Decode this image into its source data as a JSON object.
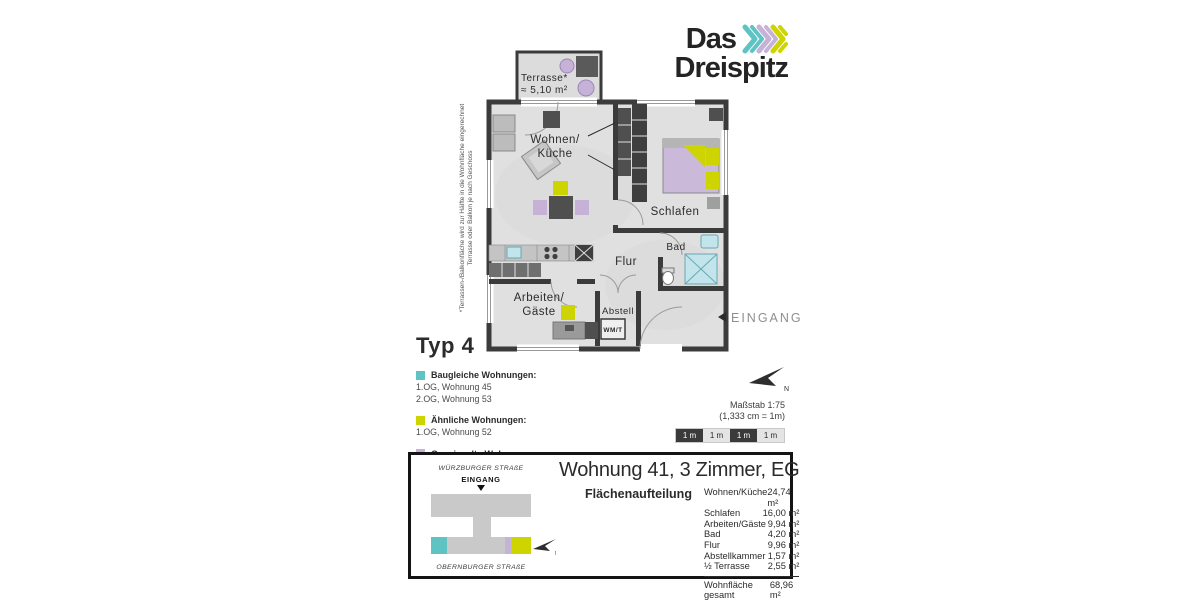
{
  "colors": {
    "teal": "#5fc3c3",
    "lavender": "#c5b2d6",
    "yellow_green": "#cdd400",
    "wall_dark": "#3b3b3b",
    "sanitary_blue": "#c2e5eb"
  },
  "logo": {
    "line1": "Das",
    "line2": "Dreispitz"
  },
  "floorplan": {
    "labels": {
      "terrasse_line1": "Terrasse*",
      "terrasse_line2": "≈ 5,10 m²",
      "wohnen_line1": "Wohnen/",
      "wohnen_line2": "Küche",
      "schlafen": "Schlafen",
      "bad": "Bad",
      "flur": "Flur",
      "arbeiten_line1": "Arbeiten/",
      "arbeiten_line2": "Gäste",
      "abstell": "Abstell",
      "wmt": "WM/T",
      "eingang": "EINGANG",
      "north": "N"
    },
    "footnote_line1": "*Terrassen-/Balkonfläche wird zur Hälfte in die Wohnfläche eingerechnet",
    "footnote_line2": "Terrasse oder Balkon je nach Geschoss"
  },
  "type_label": "Typ 4",
  "legend": [
    {
      "color": "#5fc3c3",
      "title": "Baugleiche Wohnungen:",
      "items": [
        "1.OG, Wohnung 45",
        "2.OG, Wohnung 53"
      ]
    },
    {
      "color": "#cdd400",
      "title": "Ähnliche Wohnungen:",
      "items": [
        "1.OG, Wohnung 52"
      ]
    },
    {
      "color": "#c5b2d6",
      "title": "Gespiegelte Wohnungen:",
      "items": [
        "2.OG, Wohnung 60"
      ]
    }
  ],
  "scale": {
    "line1": "Maßstab 1:75",
    "line2": "(1,333 cm = 1m)",
    "segments": [
      "1 m",
      "1 m",
      "1 m",
      "1 m"
    ]
  },
  "info_box": {
    "title": "Wohnung 41, 3 Zimmer, EG",
    "siteplan": {
      "street_top": "WÜRZBURGER STRAßE",
      "entrance": "EINGANG",
      "street_bottom": "OBERNBURGER STRAßE",
      "north": "N"
    },
    "area_table": {
      "heading": "Flächenaufteilung",
      "rows": [
        {
          "label": "Wohnen/Küche",
          "value": "24,74 m²"
        },
        {
          "label": "Schlafen",
          "value": "16,00 m²"
        },
        {
          "label": "Arbeiten/Gäste",
          "value": "9,94 m²"
        },
        {
          "label": "Bad",
          "value": "4,20 m²"
        },
        {
          "label": "Flur",
          "value": "9,96 m²"
        },
        {
          "label": "Abstellkammer",
          "value": "1,57 m²"
        },
        {
          "label": "½ Terrasse",
          "value": "2,55 m²"
        }
      ],
      "total": {
        "label": "Wohnfläche gesamt",
        "value": "68,96 m²"
      }
    }
  }
}
